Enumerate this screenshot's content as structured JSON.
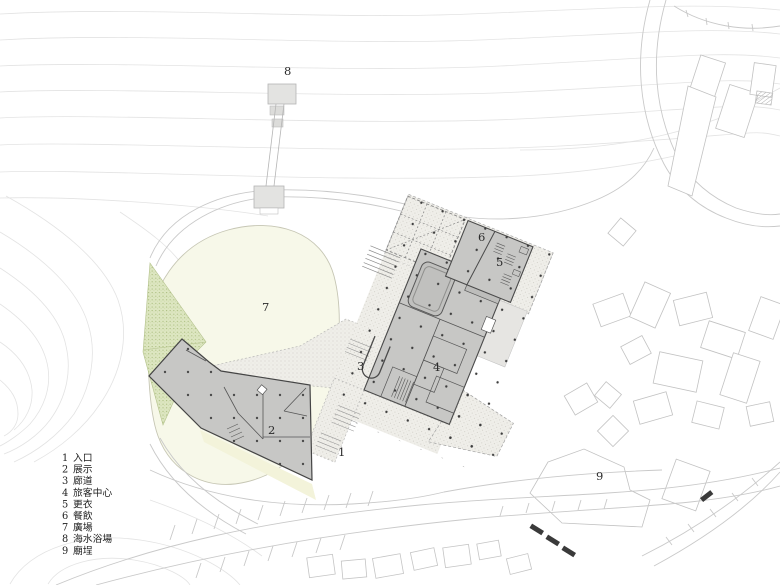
{
  "plan_labels": [
    {
      "n": "1"
    },
    {
      "n": "2"
    },
    {
      "n": "3"
    },
    {
      "n": "4"
    },
    {
      "n": "5"
    },
    {
      "n": "6"
    },
    {
      "n": "7"
    },
    {
      "n": "8"
    },
    {
      "n": "9"
    }
  ],
  "legend": {
    "items": [
      {
        "num": "1",
        "label": "入口"
      },
      {
        "num": "2",
        "label": "展示"
      },
      {
        "num": "3",
        "label": "廊道"
      },
      {
        "num": "4",
        "label": "旅客中心"
      },
      {
        "num": "5",
        "label": "更衣"
      },
      {
        "num": "6",
        "label": "餐飲"
      },
      {
        "num": "7",
        "label": "廣場"
      },
      {
        "num": "8",
        "label": "海水浴場"
      },
      {
        "num": "9",
        "label": "廟埕"
      }
    ]
  },
  "colors": {
    "building_fill": "#c7c7c5",
    "building_wall": "#4a4a4a",
    "plaza_fill": "#f7f8e9",
    "vegetation_fill": "#dde6c1",
    "paving_base": "#efeee9",
    "contour_line": "#e3e3e3",
    "context_outline": "#c2c2c2"
  }
}
